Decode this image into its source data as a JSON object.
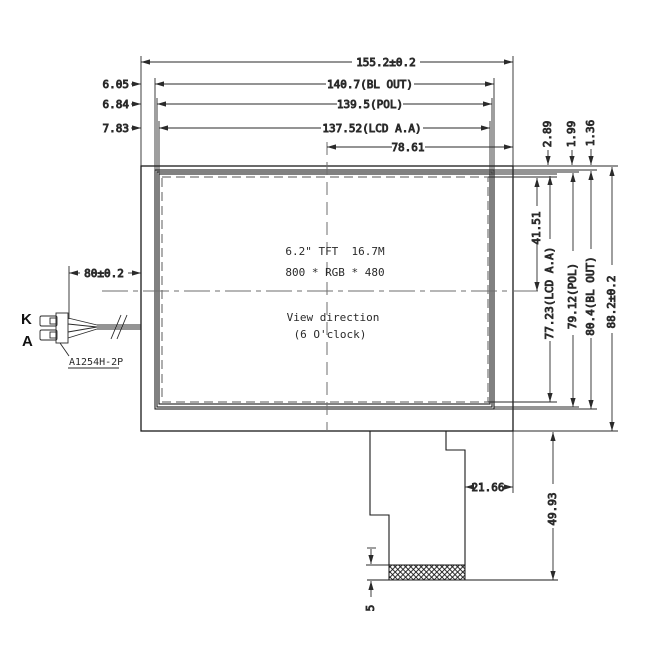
{
  "colors": {
    "background": "#ffffff",
    "line": "#2a2a2a",
    "dashed_gray": "#777777"
  },
  "dims": {
    "overall_width": "155.2±0.2",
    "bl_out_width": "140.7(BL OUT)",
    "pol_width": "139.5(POL)",
    "lcd_aa_width": "137.52(LCD A.A)",
    "center_to_right": "78.61",
    "left_offset_bl": "6.05",
    "left_offset_pol": "6.84",
    "left_offset_lcd": "7.83",
    "top_offset_lcd": "2.89",
    "top_offset_pol": "1.99",
    "top_offset_bl": "1.36",
    "aa_top_to_center": "41.51",
    "lcd_aa_height": "77.23(LCD A.A)",
    "pol_height": "79.12(POL)",
    "bl_out_height": "80.4(BL OUT)",
    "overall_height": "88.2±0.2",
    "wire_length": "80±0.2",
    "fpc_right_offset": "21.66",
    "fpc_length": "49.93",
    "contact_height": "5"
  },
  "connector": {
    "pin_top": "K",
    "pin_bottom": "A",
    "part_number": "A1254H-2P"
  },
  "display": {
    "spec_line1": "6.2\" TFT  16.7M",
    "spec_line2": "800 * RGB * 480",
    "view_line1": "View direction",
    "view_line2": "(6 O'clock)"
  }
}
